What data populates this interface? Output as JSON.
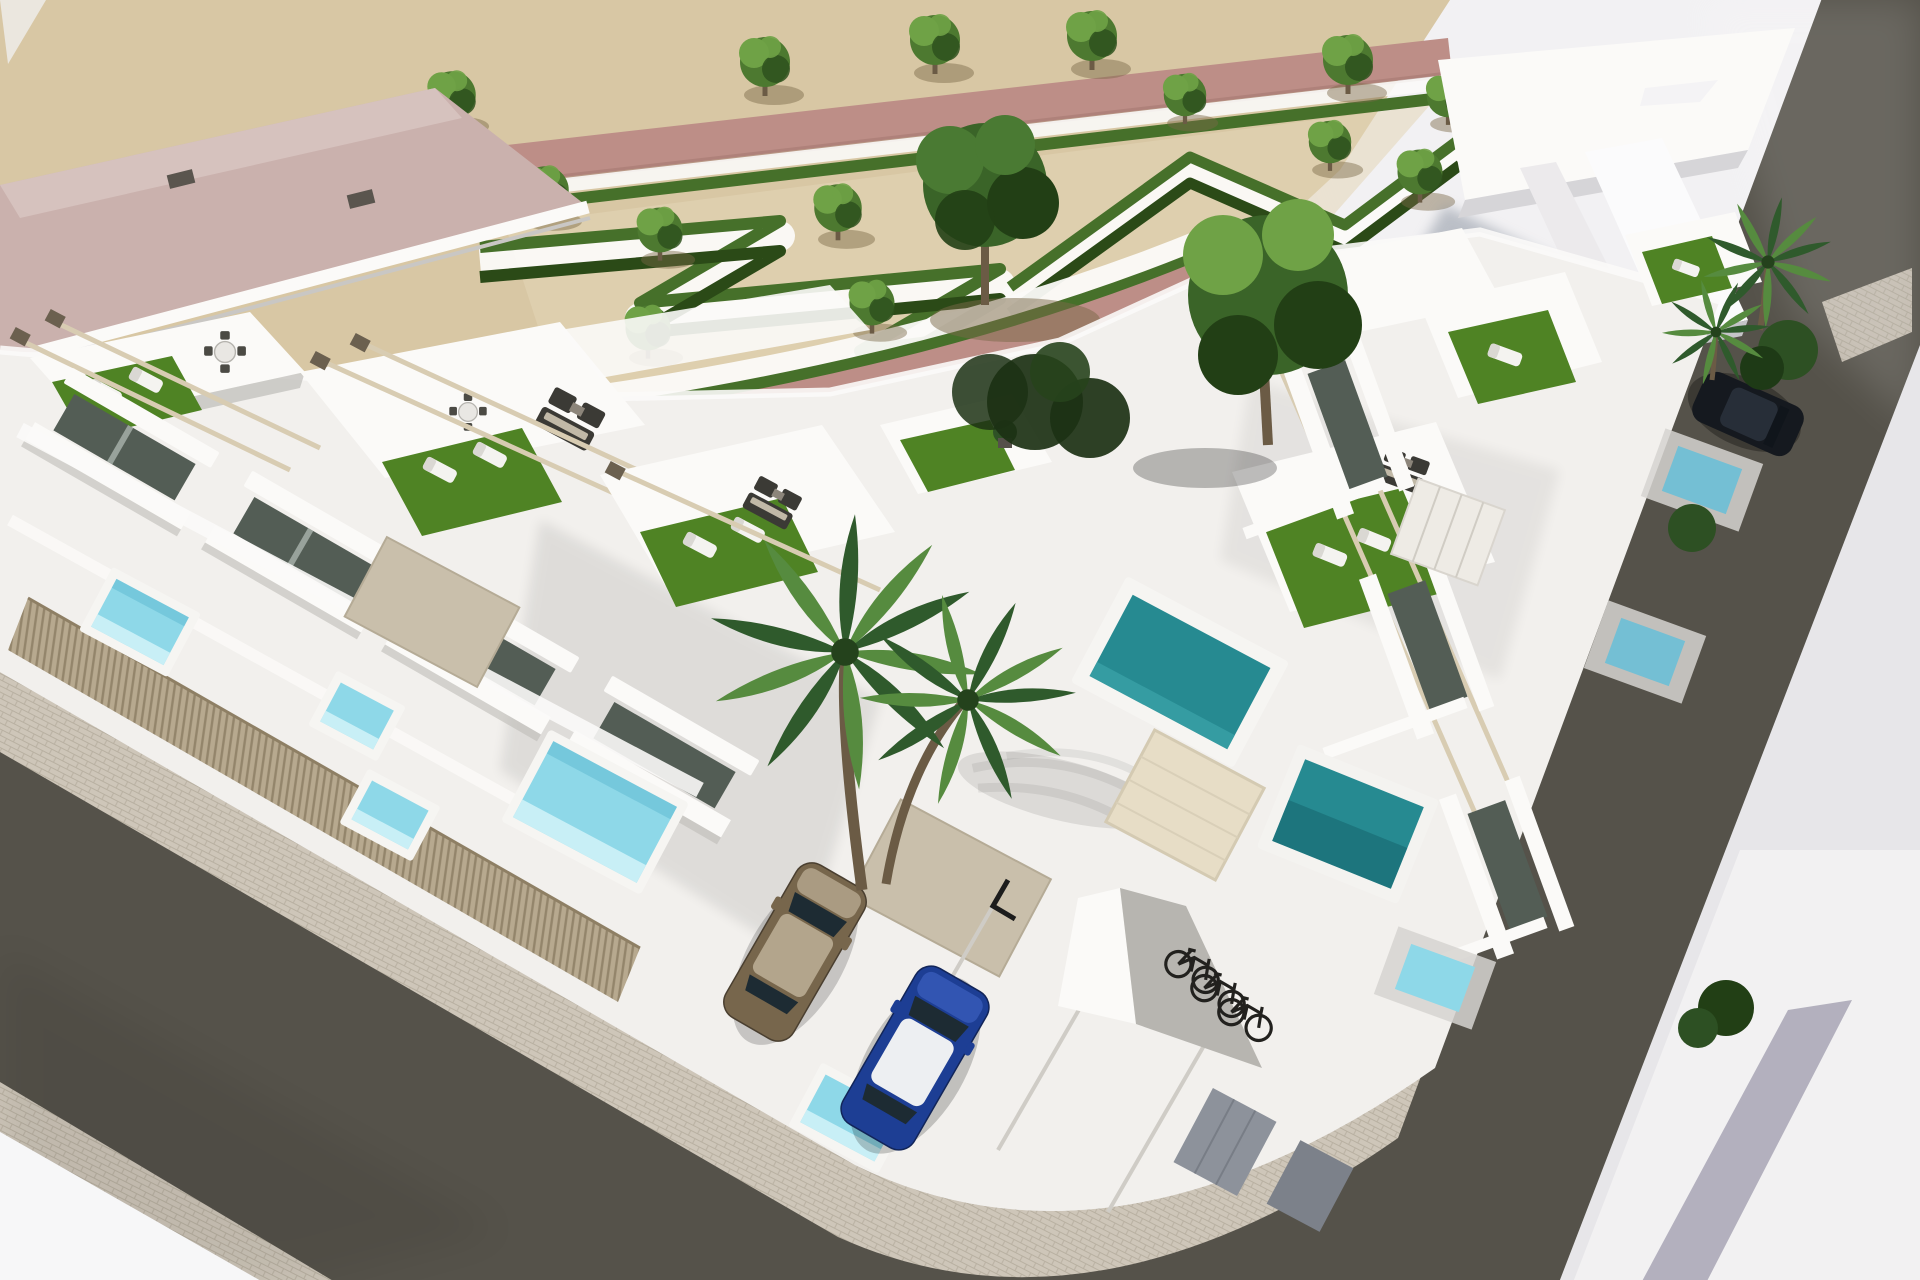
{
  "scene": {
    "type": "3d-architectural-render",
    "view": "aerial-corner",
    "subject": "modern white townhouse development on a street corner beside a landscaped park",
    "features": [
      "rooftop solarium terraces with artificial turf, sun loungers and wicker lounge sets",
      "beige timber pergola frames on roofs",
      "private aqua plunge pools behind timber slat fences",
      "communal teal pools on the right wing",
      "formal park with zigzag hedges, gravel sand ground and small trees",
      "pink pedestrian paths through the park",
      "large pink-roofed building at top left",
      "tall angular white building at top right",
      "two asphalt streets with paved sidewalks meeting at a rounded corner",
      "parking court with marked stalls",
      "bicycle nook with three bicycles",
      "large twin-trunk palm tree in the courtyard"
    ],
    "counts": {
      "cars": 3,
      "bicycles": 3,
      "aqua_plunge_pools": 5,
      "teal_pools": 2,
      "small_blue_patio_pools": 3,
      "park_trees_small": 14,
      "large_trees": 2,
      "palm_trees_large": 1,
      "palm_trees_small": 2
    },
    "cars": [
      {
        "name": "bronze-suv",
        "color_key": "car_bronze"
      },
      {
        "name": "blue-hatchback-white-roof",
        "color_key": "car_blue"
      },
      {
        "name": "dark-parked-car",
        "color_key": "car_dark"
      }
    ]
  },
  "colors": {
    "bg": "#e7e6e9",
    "bg_light": "#f4f3f5",
    "void_white": "#f7f7f8",
    "sand": "#d8c7a4",
    "sand_light": "#e4d6b6",
    "path_pink": "#bd8e87",
    "path_pink_dark": "#a67a72",
    "roof_pink": "#cab1ad",
    "roof_pink_light": "#dcc9c5",
    "hedge": "#46702a",
    "hedge_dark": "#2b4a17",
    "turf": "#4f8324",
    "turf_dark": "#3a641a",
    "tree": "#4d7930",
    "tree_light": "#6fa246",
    "tree_dark": "#2e511d",
    "big_tree": "#3a6428",
    "big_tree_dark": "#223f15",
    "palm": "#2f5a2c",
    "palm_light": "#568b3f",
    "trunk": "#6b5b45",
    "white_wall": "#f2f0ed",
    "white_bright": "#fbfaf8",
    "wall_mid": "#dedcd8",
    "wall_shadow": "#bebcb8",
    "wall_dark": "#97958f",
    "glass": "#535d55",
    "glass_dark": "#323b35",
    "pool_aqua": "#8ed8e8",
    "pool_aqua_light": "#c8eff6",
    "pool_edge": "#57b5cf",
    "pool_teal": "#268a91",
    "pool_teal_dark": "#16646e",
    "pool_blue": "#74bfd4",
    "asphalt": "#55524a",
    "asphalt_light": "#6b6862",
    "sidewalk": "#cec6b9",
    "sidewalk_line": "#b0a797",
    "wood": "#b4a58a",
    "wood_dark": "#8e7f64",
    "pergola": "#d8ccb2",
    "pergola_cap": "#6b604f",
    "lounger": "#f4f3f0",
    "wicker": "#3b3a35",
    "cushion": "#d9d0bb",
    "stone_panel": "#c9bfab",
    "car_bronze": "#77664c",
    "car_bronze_light": "#b3a58c",
    "car_blue": "#1d3e94",
    "car_blue_light": "#3558b5",
    "car_roof_white": "#edeff2",
    "car_glass": "#1d2b33",
    "car_dark": "#15191f",
    "bike": "#22211e",
    "bldg_shadow": "#8e96a3",
    "lavender": "#a3a0b0",
    "garage_door": "#e7ddc6",
    "gray_door": "#8d929b"
  }
}
